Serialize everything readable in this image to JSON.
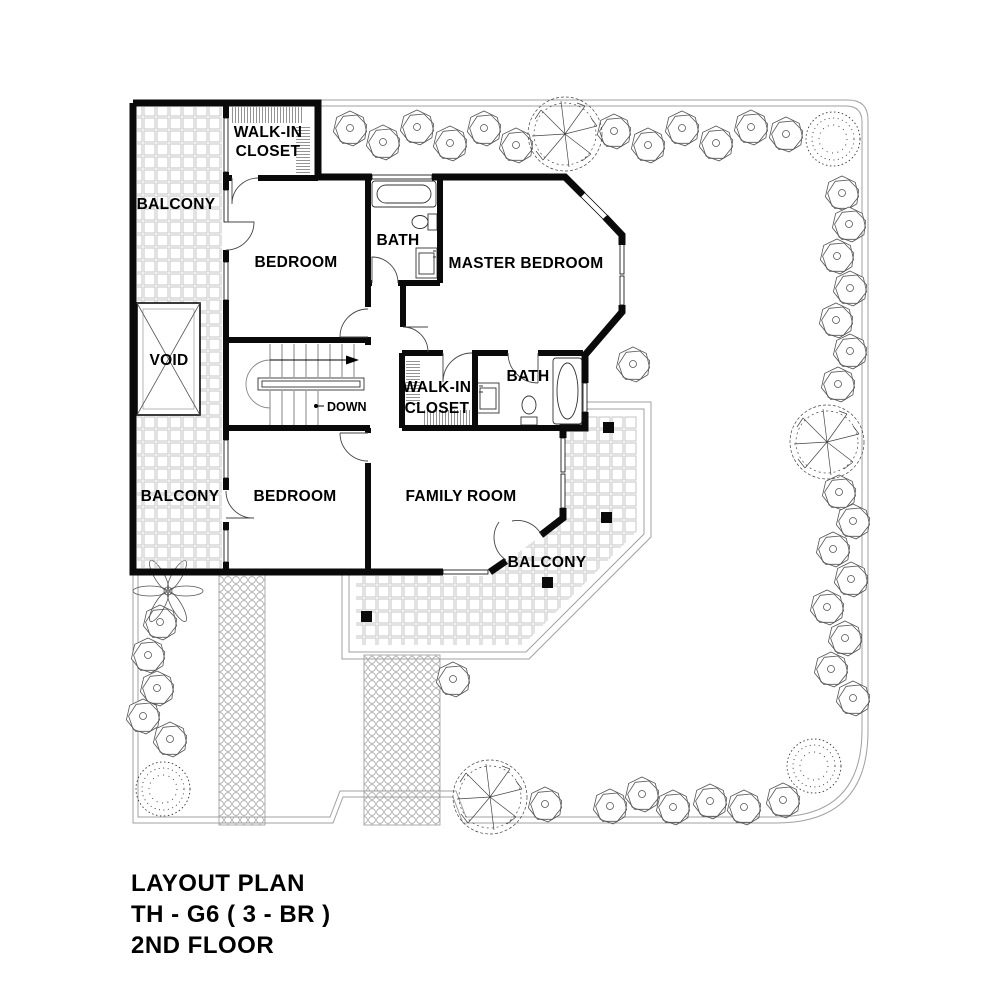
{
  "title_block": {
    "line1": "LAYOUT PLAN",
    "line2": "TH - G6 ( 3 - BR )",
    "line3": "2ND FLOOR"
  },
  "room_labels": {
    "balcony_upper": "BALCONY",
    "walk_in_closet_upper": {
      "line1": "WALK-IN",
      "line2": "CLOSET"
    },
    "bedroom_upper": "BEDROOM",
    "bath_upper": "BATH",
    "master_bedroom": "MASTER BEDROOM",
    "void": "VOID",
    "stair_direction": "DOWN",
    "walk_in_closet_lower": {
      "line1": "WALK-IN",
      "line2": "CLOSET"
    },
    "bath_lower": "BATH",
    "balcony_lower": "BALCONY",
    "bedroom_lower": "BEDROOM",
    "family_room": "FAMILY ROOM",
    "balcony_terrace": "BALCONY"
  },
  "colors": {
    "walls": "#0a0a0a",
    "background": "#ffffff",
    "tile_line": "#c6c6c6",
    "boundary_line": "#a0a0a0",
    "vegetation_line": "#555555"
  },
  "landscape": {
    "shrubs": [
      [
        350,
        128
      ],
      [
        383,
        142
      ],
      [
        417,
        127
      ],
      [
        450,
        143
      ],
      [
        484,
        128
      ],
      [
        516,
        145
      ],
      [
        614,
        131
      ],
      [
        648,
        145
      ],
      [
        682,
        128
      ],
      [
        716,
        143
      ],
      [
        751,
        127
      ],
      [
        786,
        134
      ],
      [
        842,
        193
      ],
      [
        849,
        224
      ],
      [
        837,
        256
      ],
      [
        850,
        288
      ],
      [
        836,
        320
      ],
      [
        850,
        351
      ],
      [
        838,
        384
      ],
      [
        839,
        492
      ],
      [
        853,
        521
      ],
      [
        833,
        549
      ],
      [
        851,
        579
      ],
      [
        827,
        607
      ],
      [
        845,
        638
      ],
      [
        831,
        669
      ],
      [
        853,
        698
      ],
      [
        783,
        800
      ],
      [
        744,
        807
      ],
      [
        710,
        801
      ],
      [
        673,
        807
      ],
      [
        642,
        794
      ],
      [
        610,
        806
      ],
      [
        545,
        804
      ],
      [
        453,
        679
      ],
      [
        633,
        364
      ],
      [
        160,
        622
      ],
      [
        148,
        655
      ],
      [
        157,
        688
      ],
      [
        143,
        716
      ],
      [
        170,
        739
      ]
    ],
    "big_trees": [
      [
        565,
        134
      ],
      [
        827,
        442
      ],
      [
        490,
        797
      ]
    ],
    "bushes": [
      [
        833,
        139
      ],
      [
        814,
        766
      ],
      [
        163,
        789
      ]
    ],
    "palms": [
      [
        168,
        591
      ]
    ]
  }
}
